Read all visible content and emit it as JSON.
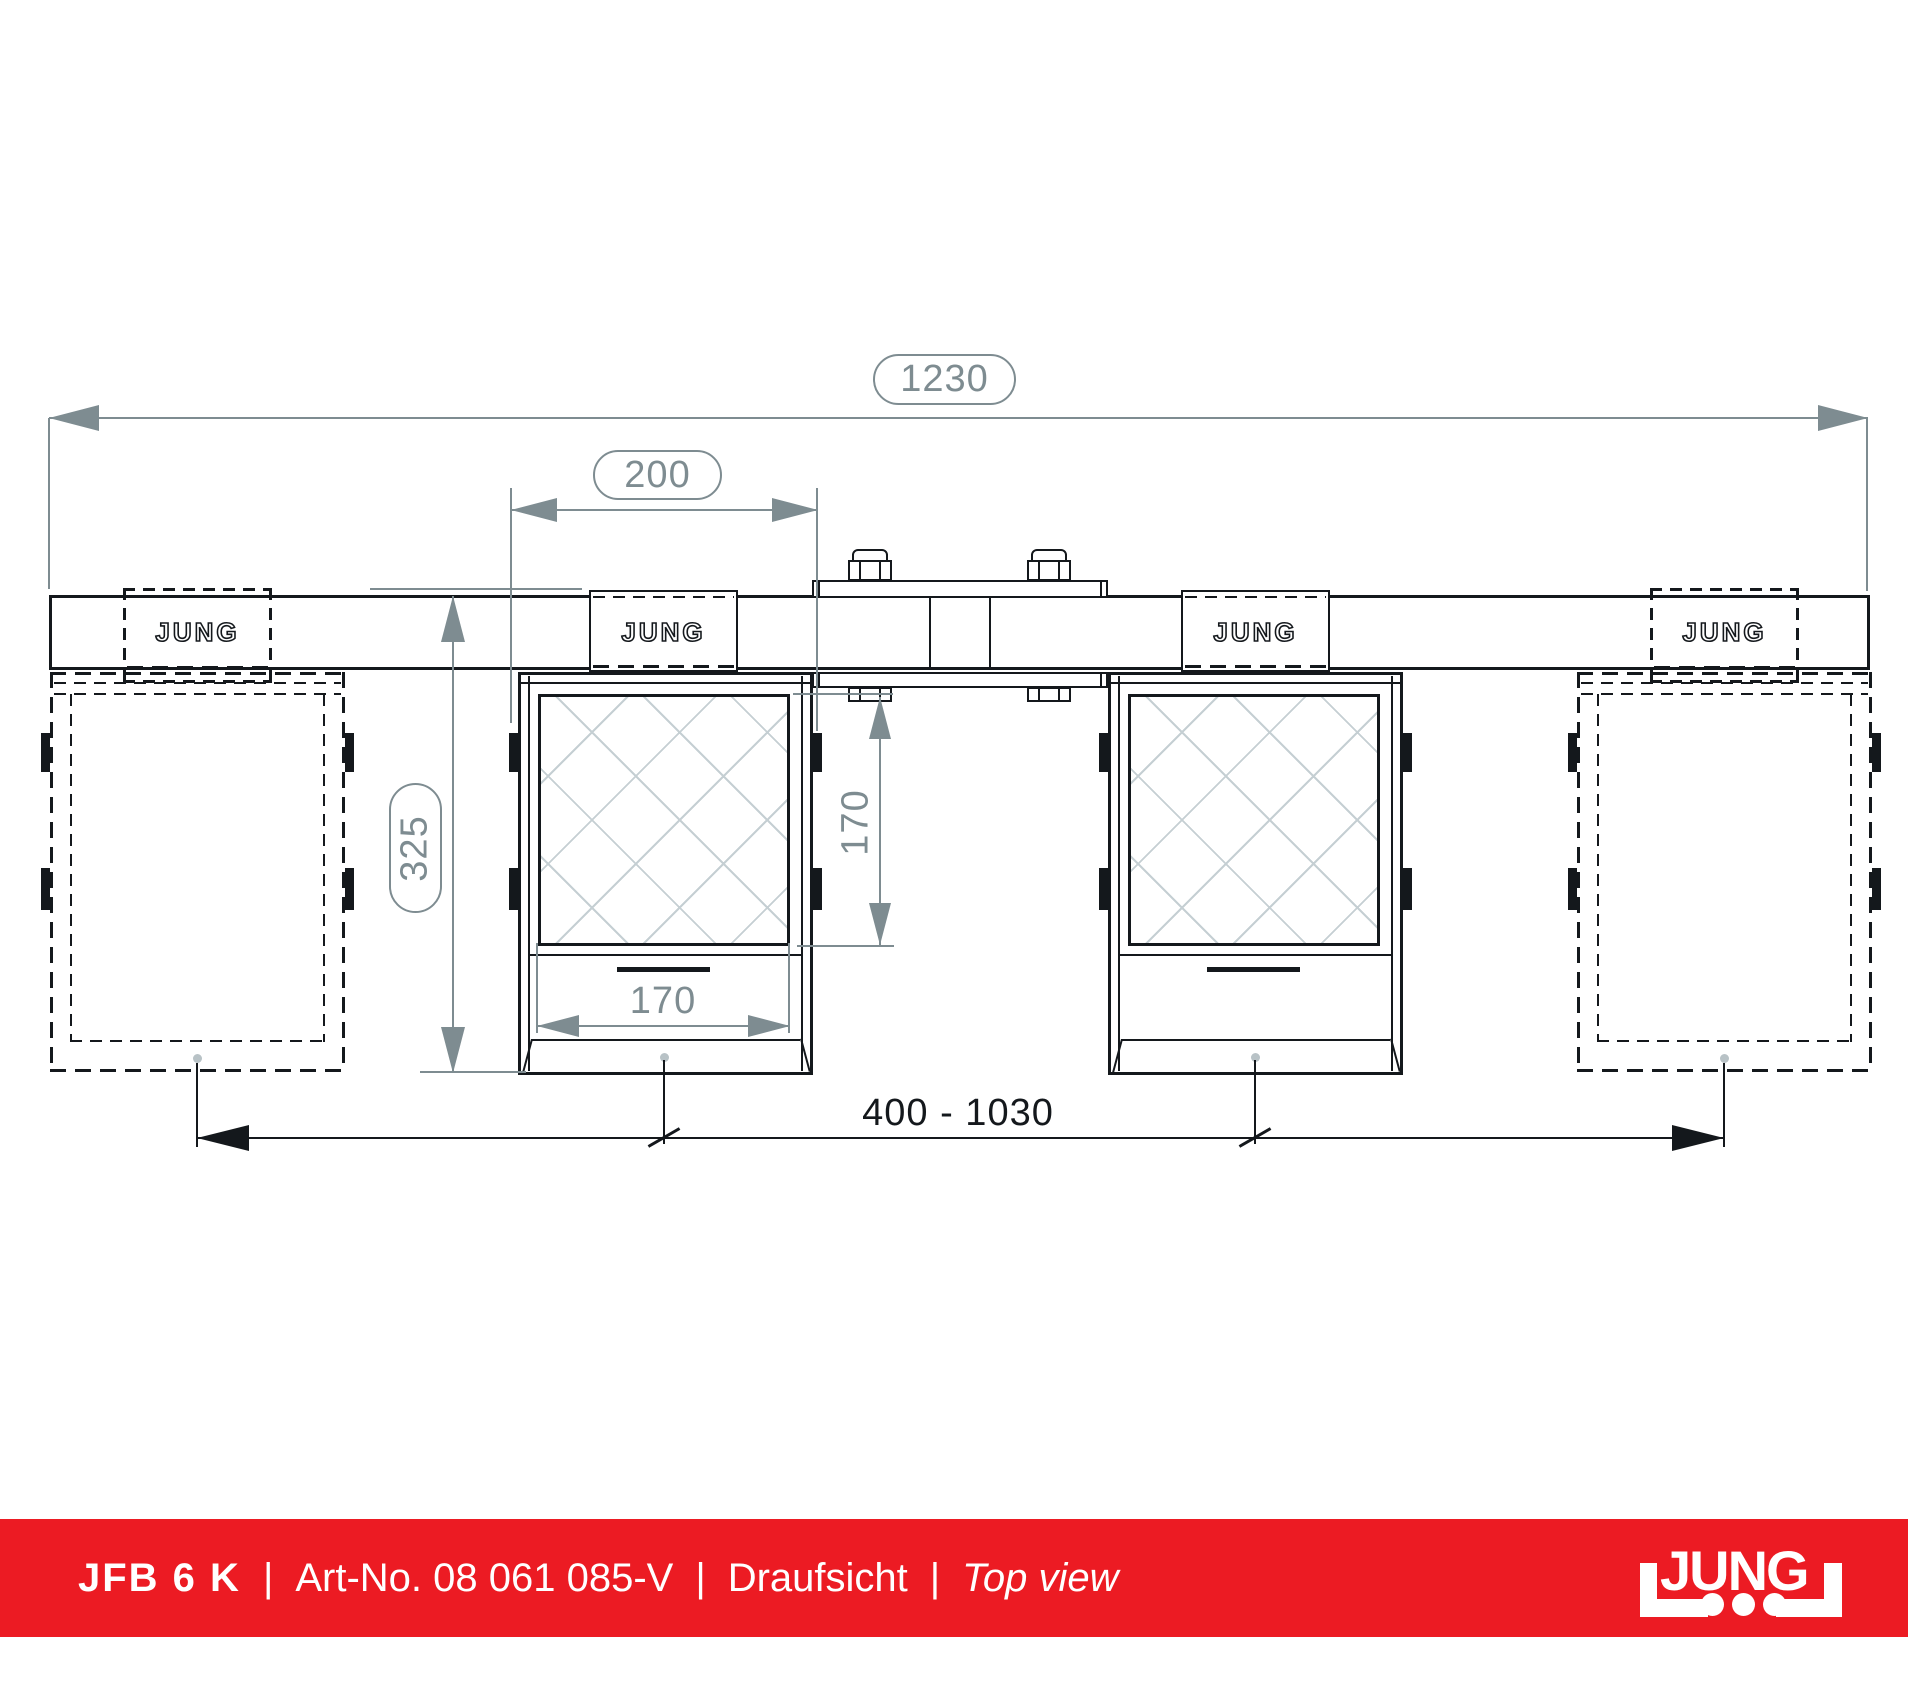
{
  "colors": {
    "line": "#14181c",
    "dimension": "#7e8c91",
    "hatch": "#c5cfd3",
    "center_mark": "#b8c2c6",
    "brand_red": "#ec1b23",
    "text_on_red": "#ffffff"
  },
  "drawing": {
    "pad_label": "JUNG",
    "dimensions": {
      "overall_width": "1230",
      "pad_width": "200",
      "total_depth": "325",
      "pocket_inner_depth": "170",
      "pocket_inner_width": "170",
      "adjust_range": "400 - 1030"
    }
  },
  "footer": {
    "model": "JFB 6 K",
    "separator": "|",
    "art_no": "Art-No. 08 061 085-V",
    "view_label_de": "Draufsicht",
    "view_label_en": "Top view",
    "logo_word": "JUNG"
  }
}
